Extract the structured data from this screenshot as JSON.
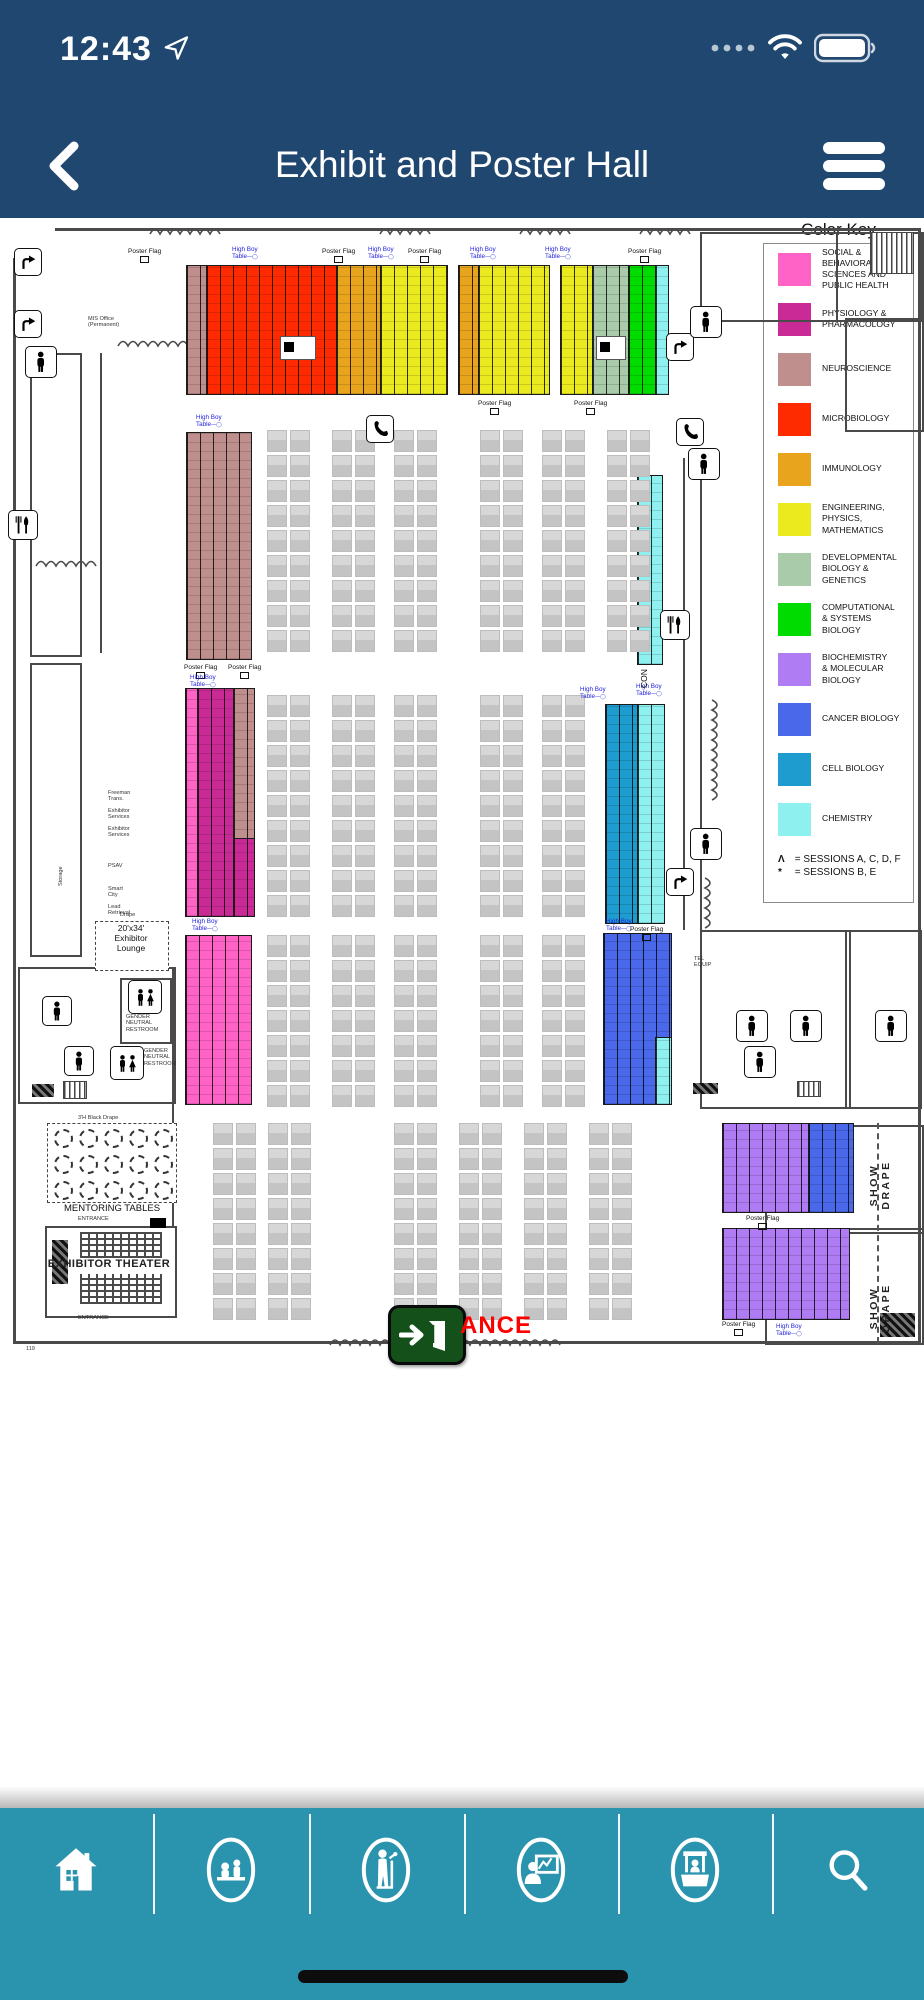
{
  "status_bar": {
    "time": "12:43",
    "icons": [
      "location-arrow-icon",
      "cellular-dots-icon",
      "wifi-icon",
      "battery-icon"
    ]
  },
  "nav_bar": {
    "title": "Exhibit and Poster Hall",
    "back_label": "back",
    "menu_label": "menu"
  },
  "legend": {
    "title": "Color Key",
    "items": [
      {
        "key": "social",
        "label": "SOCIAL & BEHAVIORAL\nSCIENCES AND\nPUBLIC HEALTH",
        "color": "#FF63C6"
      },
      {
        "key": "physiology",
        "label": "PHYSIOLOGY &\nPHARMACOLOGY",
        "color": "#C92A96"
      },
      {
        "key": "neuroscience",
        "label": "NEUROSCIENCE",
        "color": "#BF8F8D"
      },
      {
        "key": "microbiology",
        "label": "MICROBIOLOGY",
        "color": "#FF2B00"
      },
      {
        "key": "immunology",
        "label": "IMMUNOLOGY",
        "color": "#E9A41E"
      },
      {
        "key": "engineering",
        "label": "ENGINEERING,\nPHYSICS,\nMATHEMATICS",
        "color": "#EAEA1F"
      },
      {
        "key": "developmental",
        "label": "DEVELOPMENTAL\nBIOLOGY &\nGENETICS",
        "color": "#A9CBA9"
      },
      {
        "key": "computational",
        "label": "COMPUTATIONAL\n& SYSTEMS\nBIOLOGY",
        "color": "#00DC00"
      },
      {
        "key": "biochemistry",
        "label": "BIOCHEMISTRY\n& MOLECULAR\nBIOLOGY",
        "color": "#AF7CF3"
      },
      {
        "key": "cancer",
        "label": "CANCER BIOLOGY",
        "color": "#4968EA"
      },
      {
        "key": "cell",
        "label": "CELL BIOLOGY",
        "color": "#1E9CD0"
      },
      {
        "key": "chemistry",
        "label": "CHEMISTRY",
        "color": "#8FF0F0"
      }
    ],
    "notes": [
      {
        "symbol": "Λ",
        "text": "= SESSIONS A, C, D, F"
      },
      {
        "symbol": "*",
        "text": "= SESSIONS B, E"
      }
    ]
  },
  "map": {
    "poster_blocks": [
      {
        "x": 186,
        "y": 47,
        "w": 20,
        "h": 128,
        "color": "#BF8F8D"
      },
      {
        "x": 206,
        "y": 47,
        "w": 130,
        "h": 128,
        "color": "#FF2B00"
      },
      {
        "x": 336,
        "y": 47,
        "w": 44,
        "h": 128,
        "color": "#E9A41E"
      },
      {
        "x": 380,
        "y": 47,
        "w": 66,
        "h": 128,
        "color": "#EAEA1F"
      },
      {
        "x": 458,
        "y": 47,
        "w": 20,
        "h": 128,
        "color": "#E9A41E"
      },
      {
        "x": 478,
        "y": 47,
        "w": 70,
        "h": 128,
        "color": "#EAEA1F"
      },
      {
        "x": 560,
        "y": 47,
        "w": 32,
        "h": 128,
        "color": "#EAEA1F"
      },
      {
        "x": 592,
        "y": 47,
        "w": 36,
        "h": 128,
        "color": "#A9CBA9"
      },
      {
        "x": 628,
        "y": 47,
        "w": 27,
        "h": 128,
        "color": "#00DC00"
      },
      {
        "x": 655,
        "y": 47,
        "w": 12,
        "h": 128,
        "color": "#8FF0F0"
      },
      {
        "x": 186,
        "y": 214,
        "w": 64,
        "h": 226,
        "color": "#BF8F8D"
      },
      {
        "x": 637,
        "y": 257,
        "w": 24,
        "h": 188,
        "color": "#8FF0F0"
      },
      {
        "x": 185,
        "y": 470,
        "w": 12,
        "h": 227,
        "color": "#FF63C6"
      },
      {
        "x": 197,
        "y": 470,
        "w": 36,
        "h": 227,
        "color": "#C92A96"
      },
      {
        "x": 233,
        "y": 470,
        "w": 20,
        "h": 150,
        "color": "#BF8F8D"
      },
      {
        "x": 233,
        "y": 620,
        "w": 20,
        "h": 77,
        "color": "#C92A96"
      },
      {
        "x": 605,
        "y": 486,
        "w": 32,
        "h": 218,
        "color": "#1E9CD0"
      },
      {
        "x": 637,
        "y": 486,
        "w": 26,
        "h": 218,
        "color": "#8FF0F0"
      },
      {
        "x": 185,
        "y": 717,
        "w": 65,
        "h": 168,
        "color": "#FF63C6"
      },
      {
        "x": 603,
        "y": 715,
        "w": 67,
        "h": 170,
        "color": "#4968EA"
      },
      {
        "x": 655,
        "y": 819,
        "w": 15,
        "h": 66,
        "color": "#8FF0F0"
      },
      {
        "x": 722,
        "y": 905,
        "w": 86,
        "h": 88,
        "color": "#AF7CF3"
      },
      {
        "x": 808,
        "y": 905,
        "w": 44,
        "h": 88,
        "color": "#4968EA"
      },
      {
        "x": 722,
        "y": 1010,
        "w": 126,
        "h": 90,
        "color": "#AF7CF3"
      }
    ],
    "cutouts": [
      {
        "x": 280,
        "y": 118,
        "w": 34,
        "h": 22
      },
      {
        "x": 596,
        "y": 118,
        "w": 28,
        "h": 22
      }
    ],
    "booth_grids": [
      {
        "x": 267,
        "y": 212,
        "rows": 9
      },
      {
        "x": 332,
        "y": 212,
        "rows": 9
      },
      {
        "x": 394,
        "y": 212,
        "rows": 9
      },
      {
        "x": 480,
        "y": 212,
        "rows": 9
      },
      {
        "x": 542,
        "y": 212,
        "rows": 9
      },
      {
        "x": 607,
        "y": 212,
        "rows": 9
      },
      {
        "x": 267,
        "y": 477,
        "rows": 9
      },
      {
        "x": 332,
        "y": 477,
        "rows": 9
      },
      {
        "x": 394,
        "y": 477,
        "rows": 9
      },
      {
        "x": 480,
        "y": 477,
        "rows": 9
      },
      {
        "x": 542,
        "y": 477,
        "rows": 9
      },
      {
        "x": 267,
        "y": 717,
        "rows": 7
      },
      {
        "x": 332,
        "y": 717,
        "rows": 7
      },
      {
        "x": 394,
        "y": 717,
        "rows": 7
      },
      {
        "x": 480,
        "y": 717,
        "rows": 7
      },
      {
        "x": 542,
        "y": 717,
        "rows": 7
      },
      {
        "x": 213,
        "y": 905,
        "rows": 8
      },
      {
        "x": 268,
        "y": 905,
        "rows": 8
      },
      {
        "x": 394,
        "y": 905,
        "rows": 8
      },
      {
        "x": 459,
        "y": 905,
        "rows": 8
      },
      {
        "x": 524,
        "y": 905,
        "rows": 8
      },
      {
        "x": 589,
        "y": 905,
        "rows": 8
      }
    ],
    "walls": [
      {
        "x": 55,
        "y": 10,
        "w": 865,
        "h": 3
      },
      {
        "x": 13,
        "y": 40,
        "w": 3,
        "h": 1085
      },
      {
        "x": 13,
        "y": 1123,
        "w": 907,
        "h": 3
      },
      {
        "x": 918,
        "y": 10,
        "w": 3,
        "h": 1115
      },
      {
        "x": 683,
        "y": 240,
        "w": 2,
        "h": 472
      },
      {
        "x": 700,
        "y": 240,
        "w": 2,
        "h": 472
      },
      {
        "x": 100,
        "y": 135,
        "w": 2,
        "h": 300
      },
      {
        "x": 172,
        "y": 749,
        "w": 2,
        "h": 260
      }
    ],
    "rooms": [
      {
        "x": 700,
        "y": 14,
        "w": 218,
        "h": 86
      },
      {
        "x": 836,
        "y": 14,
        "w": 84,
        "h": 86
      },
      {
        "x": 845,
        "y": 100,
        "w": 75,
        "h": 110
      },
      {
        "x": 700,
        "y": 712,
        "w": 218,
        "h": 175
      },
      {
        "x": 845,
        "y": 712,
        "w": 2,
        "h": 175
      },
      {
        "x": 765,
        "y": 907,
        "w": 155,
        "h": 216
      },
      {
        "x": 765,
        "y": 1010,
        "w": 155,
        "h": 2
      },
      {
        "x": 18,
        "y": 749,
        "w": 154,
        "h": 133
      },
      {
        "x": 120,
        "y": 760,
        "w": 48,
        "h": 62
      },
      {
        "x": 30,
        "y": 135,
        "w": 48,
        "h": 300
      },
      {
        "x": 30,
        "y": 445,
        "w": 48,
        "h": 290
      },
      {
        "x": 45,
        "y": 1008,
        "w": 128,
        "h": 88
      }
    ],
    "hatches": [
      {
        "x": 32,
        "y": 866,
        "w": 22,
        "h": 13
      },
      {
        "x": 693,
        "y": 865,
        "w": 25,
        "h": 11
      },
      {
        "x": 880,
        "y": 1095,
        "w": 35,
        "h": 24
      },
      {
        "x": 52,
        "y": 1022,
        "w": 16,
        "h": 44
      }
    ],
    "stairs": [
      {
        "x": 870,
        "y": 14,
        "w": 42,
        "h": 40
      },
      {
        "x": 63,
        "y": 863,
        "w": 22,
        "h": 16
      },
      {
        "x": 797,
        "y": 863,
        "w": 22,
        "h": 14
      }
    ],
    "icons": [
      {
        "name": "escalator-arrow-icon",
        "x": 14,
        "y": 30,
        "s": 26
      },
      {
        "name": "escalator-arrow-icon",
        "x": 14,
        "y": 92,
        "s": 26
      },
      {
        "name": "escalator-arrow-icon",
        "x": 666,
        "y": 115,
        "s": 26
      },
      {
        "name": "escalator-arrow-icon",
        "x": 666,
        "y": 650,
        "s": 26
      },
      {
        "name": "restroom-icon",
        "x": 25,
        "y": 128,
        "s": 30
      },
      {
        "name": "restroom-icon",
        "x": 690,
        "y": 88,
        "s": 30
      },
      {
        "name": "restroom-icon",
        "x": 688,
        "y": 230,
        "s": 30
      },
      {
        "name": "restroom-icon",
        "x": 690,
        "y": 610,
        "s": 30
      },
      {
        "name": "restroom-icon",
        "x": 736,
        "y": 792,
        "s": 30
      },
      {
        "name": "restroom-icon",
        "x": 790,
        "y": 792,
        "s": 30
      },
      {
        "name": "restroom-icon",
        "x": 744,
        "y": 828,
        "s": 30
      },
      {
        "name": "restroom-icon",
        "x": 875,
        "y": 792,
        "s": 30
      },
      {
        "name": "restroom-icon",
        "x": 42,
        "y": 778,
        "s": 28
      },
      {
        "name": "restroom-icon",
        "x": 64,
        "y": 828,
        "s": 28
      },
      {
        "name": "restroom-double-icon",
        "x": 128,
        "y": 762,
        "s": 32
      },
      {
        "name": "restroom-double-icon",
        "x": 110,
        "y": 828,
        "s": 32
      },
      {
        "name": "phone-icon",
        "x": 366,
        "y": 197,
        "s": 26
      },
      {
        "name": "phone-icon",
        "x": 676,
        "y": 200,
        "s": 26
      },
      {
        "name": "restaurant-icon",
        "x": 8,
        "y": 292,
        "s": 28
      },
      {
        "name": "restaurant-icon",
        "x": 660,
        "y": 392,
        "s": 28
      }
    ],
    "squiggles": [
      {
        "x": 150,
        "y": 6,
        "w": 70,
        "h": 12,
        "v": false
      },
      {
        "x": 380,
        "y": 6,
        "w": 56,
        "h": 12,
        "v": false
      },
      {
        "x": 520,
        "y": 6,
        "w": 56,
        "h": 12,
        "v": false
      },
      {
        "x": 640,
        "y": 6,
        "w": 50,
        "h": 12,
        "v": false
      },
      {
        "x": 118,
        "y": 118,
        "w": 90,
        "h": 12,
        "v": false
      },
      {
        "x": 36,
        "y": 338,
        "w": 66,
        "h": 12,
        "v": false
      },
      {
        "x": 330,
        "y": 1116,
        "w": 60,
        "h": 13,
        "v": false
      },
      {
        "x": 460,
        "y": 1116,
        "w": 100,
        "h": 13,
        "v": false
      },
      {
        "x": 710,
        "y": 482,
        "w": 13,
        "h": 105,
        "v": true
      },
      {
        "x": 703,
        "y": 660,
        "w": 13,
        "h": 50,
        "v": true
      }
    ],
    "labels": [
      {
        "t": "Poster Flag",
        "x": 128,
        "y": 30,
        "c": "pf"
      },
      {
        "t": "Poster Flag",
        "x": 322,
        "y": 30,
        "c": "pf"
      },
      {
        "t": "Poster Flag",
        "x": 408,
        "y": 30,
        "c": "pf"
      },
      {
        "t": "Poster Flag",
        "x": 628,
        "y": 30,
        "c": "pf"
      },
      {
        "t": "High Boy\nTable",
        "x": 232,
        "y": 28,
        "c": "hb"
      },
      {
        "t": "High Boy\nTable",
        "x": 368,
        "y": 28,
        "c": "hb"
      },
      {
        "t": "High Boy\nTable",
        "x": 470,
        "y": 28,
        "c": "hb"
      },
      {
        "t": "High Boy\nTable",
        "x": 545,
        "y": 28,
        "c": "hb"
      },
      {
        "t": "Poster Flag",
        "x": 478,
        "y": 182,
        "c": "pf"
      },
      {
        "t": "Poster Flag",
        "x": 574,
        "y": 182,
        "c": "pf"
      },
      {
        "t": "High Boy\nTable",
        "x": 196,
        "y": 196,
        "c": "hb"
      },
      {
        "t": "Poster Flag",
        "x": 184,
        "y": 446,
        "c": "pf"
      },
      {
        "t": "Poster Flag",
        "x": 228,
        "y": 446,
        "c": "pf"
      },
      {
        "t": "High Boy\nTable",
        "x": 190,
        "y": 456,
        "c": "hb"
      },
      {
        "t": "High Boy\nTable",
        "x": 580,
        "y": 468,
        "c": "hb"
      },
      {
        "t": "High Boy\nTable",
        "x": 636,
        "y": 465,
        "c": "hb"
      },
      {
        "t": "Poster Flag",
        "x": 630,
        "y": 708,
        "c": "pf"
      },
      {
        "t": "High Boy\nTable",
        "x": 192,
        "y": 700,
        "c": "hb"
      },
      {
        "t": "High Boy\nTable",
        "x": 606,
        "y": 700,
        "c": "hb"
      },
      {
        "t": "Poster Flag",
        "x": 746,
        "y": 997,
        "c": "pf"
      },
      {
        "t": "Poster Flag",
        "x": 722,
        "y": 1103,
        "c": "pf"
      },
      {
        "t": "High Boy\nTable",
        "x": 776,
        "y": 1105,
        "c": "hb"
      },
      {
        "t": "MIS Office\n(Permanent)",
        "x": 88,
        "y": 98,
        "c": "tiny"
      },
      {
        "t": "MENTORING TABLES",
        "x": 48,
        "y": 986,
        "c": "t9",
        "w": 128
      },
      {
        "t": "3'H Black Drape",
        "x": 78,
        "y": 897,
        "c": "tiny"
      },
      {
        "t": "EXHIBITOR THEATER",
        "x": 45,
        "y": 1040,
        "c": "t10",
        "w": 128
      },
      {
        "t": "ENTRANCE",
        "x": 78,
        "y": 998,
        "c": "tiny"
      },
      {
        "t": "ENTRANCE",
        "x": 78,
        "y": 1097,
        "c": "tiny"
      },
      {
        "t": "20'x34'\nExhibitor\nLounge",
        "x": 95,
        "y": 706,
        "c": "t8",
        "w": 72
      },
      {
        "t": "Drape",
        "x": 120,
        "y": 694,
        "c": "tiny"
      },
      {
        "t": "GENDER\nNEUTRAL\nRESTROOM",
        "x": 126,
        "y": 796,
        "c": "tiny"
      },
      {
        "t": "GENDER\nNEUTRAL\nRESTROOM",
        "x": 144,
        "y": 830,
        "c": "tiny"
      },
      {
        "t": "Freeman\nTrans.",
        "x": 108,
        "y": 572,
        "c": "tiny"
      },
      {
        "t": "Exhibitor\nServices",
        "x": 108,
        "y": 590,
        "c": "tiny"
      },
      {
        "t": "Exhibitor\nServices",
        "x": 108,
        "y": 608,
        "c": "tiny"
      },
      {
        "t": "PSAV",
        "x": 108,
        "y": 645,
        "c": "tiny"
      },
      {
        "t": "Smart\nCity",
        "x": 108,
        "y": 668,
        "c": "tiny"
      },
      {
        "t": "Lead\nRetrieval",
        "x": 108,
        "y": 686,
        "c": "tiny"
      },
      {
        "t": "TEL\nEQUIP",
        "x": 694,
        "y": 738,
        "c": "tiny"
      },
      {
        "t": "119",
        "x": 26,
        "y": 1128,
        "c": "tiny"
      },
      {
        "t": "ANCE",
        "x": 460,
        "y": 1094,
        "c": "red-big"
      },
      {
        "t": "Storage",
        "x": 58,
        "y": 668,
        "c": "tiny rot"
      },
      {
        "t": "CON",
        "x": 640,
        "y": 470,
        "c": "t8 rot"
      },
      {
        "t": "SHOW  DRAPE",
        "x": 868,
        "y": 995,
        "c": "sd rot"
      },
      {
        "t": "SHOW  DRAPE",
        "x": 868,
        "y": 1118,
        "c": "sd rot"
      }
    ],
    "mentoring": {
      "box": {
        "x": 47,
        "y": 905,
        "w": 128,
        "h": 78
      },
      "cols": 5,
      "rows": 3
    },
    "lounge_box": {
      "x": 95,
      "y": 703,
      "w": 72,
      "h": 48
    },
    "theater": {
      "seats": [
        {
          "x": 80,
          "y": 1014,
          "w": 82,
          "h": 26
        },
        {
          "x": 80,
          "y": 1056,
          "w": 82,
          "h": 30
        }
      ],
      "blacksq": {
        "x": 150,
        "y": 1000,
        "w": 16,
        "h": 10
      }
    },
    "show_drape_line": {
      "x": 877,
      "y": 905,
      "h": 220
    },
    "entrance": {
      "box": {
        "x": 388,
        "y": 1087,
        "w": 72,
        "h": 54
      }
    }
  },
  "toolbar": {
    "items": [
      {
        "name": "home-icon"
      },
      {
        "name": "attendees-icon"
      },
      {
        "name": "speakers-icon"
      },
      {
        "name": "posters-icon"
      },
      {
        "name": "exhibitors-icon"
      },
      {
        "name": "search-icon"
      }
    ]
  }
}
